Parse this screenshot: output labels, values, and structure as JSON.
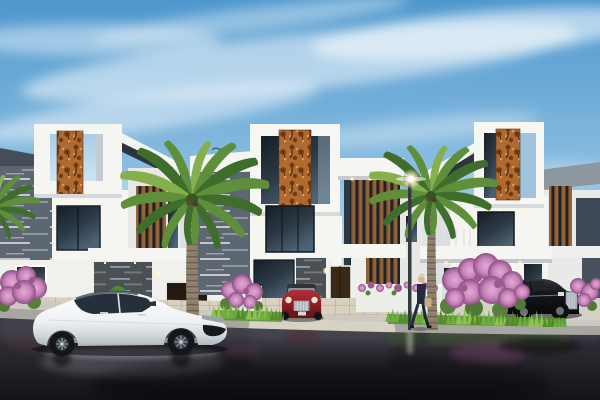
{
  "image": {
    "kind": "3D architectural exterior rendering",
    "subject": "Row of modern white luxury villas with rust-toned laser-cut facade panels",
    "setting": "Residential street, daytime, wet reflective asphalt road in the foreground",
    "sky": "Light blue sky with thin wispy white clouds",
    "visible_text": "none"
  },
  "scene": {
    "buildings": [
      {
        "id": "left-villa",
        "label": "Left villa",
        "features": "rooftop frame cube with rust filigree panel, slanted white roof, gray ledgestone cladding, timber slat screen, entry door with lit wall lamps"
      },
      {
        "id": "center-villa",
        "label": "Center villa",
        "features": "tall white tower with rust filigree panel, gray ledgestone wing, tall glazing, timber slat balcony screens, dark timber entry door, paver driveway"
      },
      {
        "id": "right-villa",
        "label": "Right villa",
        "features": "rooftop frame cube with rust filigree panel, slanted dark roof, long balcony slab, timber slats"
      },
      {
        "id": "background-houses",
        "label": "Background houses",
        "features": "additional white villas with gray roof slabs and dark slate accent panels"
      }
    ],
    "vehicles": [
      {
        "id": "white-sedan",
        "label": "White electric luxury sedan",
        "color_key": "car_white",
        "position": "foreground left, side view facing right"
      },
      {
        "id": "red-car",
        "label": "Dark red luxury car with chrome mesh grille",
        "color_key": "car_red",
        "position": "center driveway, front view"
      },
      {
        "id": "black-car",
        "label": "Black luxury sedan with upright chrome grille",
        "color_key": "car_black",
        "position": "right side, partly behind flowering bush"
      }
    ],
    "figures": [
      {
        "id": "pedestrian",
        "label": "Man in a dark suit carrying a tan bag, walking on the sidewalk"
      }
    ],
    "vegetation": [
      {
        "id": "palm-left",
        "label": "Large palm tree between left and center villas"
      },
      {
        "id": "palm-right",
        "label": "Palm tree in front of right villa"
      },
      {
        "id": "pink-bushes",
        "label": "Pink flowering bushes",
        "count": 4
      },
      {
        "id": "grass",
        "label": "Bright green grass tufts along curb and planters"
      }
    ],
    "street": {
      "furniture": [
        "lit street lamp"
      ],
      "surface": "wet dark asphalt mirroring cars, grass, flowers and lamp light",
      "sidewalk": "light concrete walkway and curb",
      "driveway": "beige stone pavers"
    },
    "sky_objects": {
      "birds": 2
    }
  },
  "colors": {
    "sky_top": "#4d97cd",
    "sky_mid": "#8fc0e2",
    "sky_horizon": "#d8e9f4",
    "cloud": "#f5fafd",
    "wall_white": "#f5f5f2",
    "wall_shadow": "#dce0e3",
    "cladding": "#5d6771",
    "rust": "#b0692f",
    "rust_dark": "#6d3c14",
    "wood": "#96663a",
    "glass": "#2c3a46",
    "roof_dark": "#2e343b",
    "palm_dark": "#3f6d2c",
    "palm_mid": "#5f8f3a",
    "palm_light": "#86b04e",
    "trunk": "#8d7f6b",
    "grass": "#6fae3e",
    "flower_pink": "#c783ba",
    "flower_deep": "#9a5a8e",
    "road_top": "#3b3740",
    "road_bottom": "#141318",
    "sidewalk": "#cbc9c2",
    "paver": "#d9d0c0",
    "car_white": "#f7f8f9",
    "car_red": "#8e2025",
    "car_black": "#15171c",
    "chrome": "#c3c7cb",
    "suit": "#242c3e",
    "bag": "#c8ab84",
    "glow": "#fff3cf"
  }
}
